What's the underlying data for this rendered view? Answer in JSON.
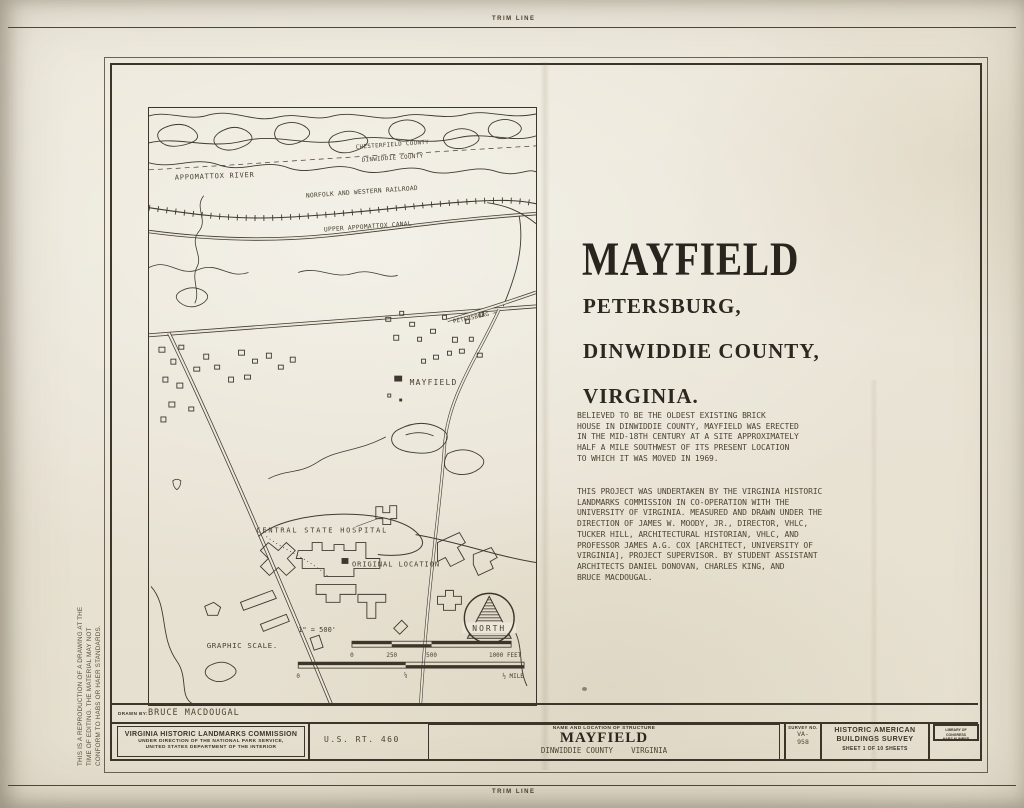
{
  "page": {
    "trim_top": "TRIM LINE",
    "trim_bottom": "TRIM LINE"
  },
  "side_note": [
    "THIS IS A REPRODUCTION OF A DRAWING AT THE",
    "TIME OF EDITING. THE MATERIAL MAY NOT",
    "CONFORM TO HABS OR HAER STANDARDS."
  ],
  "heading": {
    "title": "MAYFIELD",
    "subtitle": [
      "PETERSBURG,",
      "DINWIDDIE COUNTY,",
      "VIRGINIA."
    ]
  },
  "paragraphs": {
    "p1": [
      "BELIEVED TO BE THE OLDEST EXISTING BRICK",
      "HOUSE IN DINWIDDIE COUNTY, MAYFIELD WAS ERECTED",
      "IN THE MID-18TH CENTURY AT A SITE APPROXIMATELY",
      "HALF A MILE SOUTHWEST OF ITS PRESENT LOCATION",
      "TO WHICH IT WAS MOVED IN 1969."
    ],
    "p2": [
      "THIS PROJECT WAS UNDERTAKEN BY THE VIRGINIA HISTORIC",
      "LANDMARKS COMMISSION IN CO-OPERATION WITH THE",
      "UNIVERSITY OF VIRGINIA. MEASURED AND DRAWN UNDER THE",
      "DIRECTION OF JAMES W. MOODY, JR., DIRECTOR, VHLC,",
      "TUCKER HILL, ARCHITECTURAL HISTORIAN, VHLC, AND",
      "PROFESSOR JAMES A.G. COX [ARCHITECT, UNIVERSITY OF",
      "VIRGINIA], PROJECT SUPERVISOR. BY STUDENT ASSISTANT",
      "ARCHITECTS DANIEL DONOVAN, CHARLES KING, AND",
      "BRUCE MACDOUGAL."
    ]
  },
  "map": {
    "labels": {
      "river": "APPOMATTOX RIVER",
      "county_top": "CHESTERFIELD COUNTY",
      "county_bottom": "DINWIDDIE COUNTY",
      "railroad": "NORFOLK AND WESTERN RAILROAD",
      "canal": "UPPER APPOMATTOX CANAL",
      "petersburg": "PETERSBURG →",
      "mayfield": "MAYFIELD",
      "hospital": "CENTRAL STATE HOSPITAL",
      "original_location": "ORIGINAL LOCATION",
      "north": "NORTH"
    },
    "scale": {
      "ratio": "1\" = 500'",
      "label": "GRAPHIC SCALE.",
      "feet": [
        "0",
        "250",
        "500",
        "1000 FEET"
      ],
      "miles": [
        "0",
        "¼",
        "½ MILE"
      ]
    }
  },
  "title_block": {
    "drawn_by_label": "DRAWN BY:",
    "drawn_by_name": "BRUCE MACDOUGAL",
    "agency_name": "VIRGINIA HISTORIC LANDMARKS COMMISSION",
    "agency_sub": [
      "UNDER DIRECTION OF THE NATIONAL PARK SERVICE,",
      "UNITED STATES DEPARTMENT OF THE INTERIOR"
    ],
    "route": "U.S. RT. 460",
    "name_header": "NAME AND LOCATION OF STRUCTURE",
    "structure_name": "MAYFIELD",
    "structure_county": "DINWIDDIE COUNTY",
    "structure_state": "VIRGINIA",
    "survey_label": "SURVEY NO.",
    "survey_value": [
      "VA-",
      "958"
    ],
    "habs_title": [
      "HISTORIC AMERICAN",
      "BUILDINGS SURVEY"
    ],
    "sheet_info": "SHEET 1 OF 10 SHEETS",
    "loc_stamp": [
      "LIBRARY OF CONGRESS",
      "HABS NUMBER"
    ]
  },
  "colors": {
    "ink": "#3b352a",
    "paper": "#ebe6d8"
  }
}
